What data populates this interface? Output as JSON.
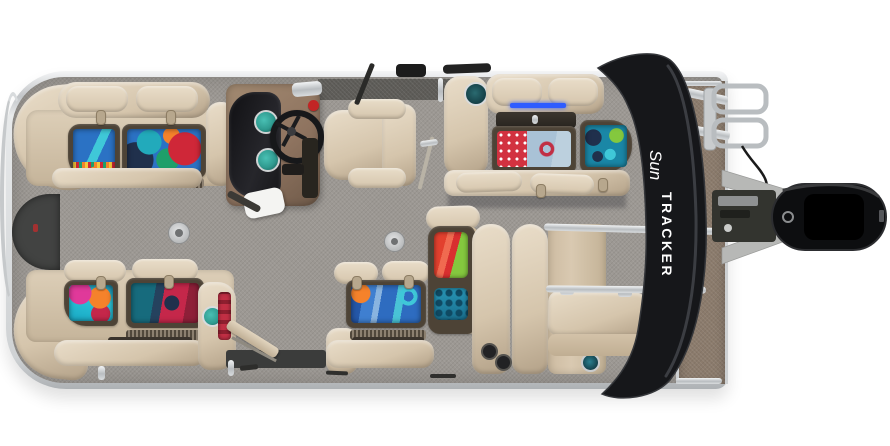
{
  "alt": "Overhead view of a SUN TRACKER pontoon boat: tan upholstered lounges with open storage bins of colorful gear, brown helm console with steering wheel, captain's chair, gray woven deck carpet, folded black bimini top with brand logo, taupe stern deck, boarding ladder, gray pontoon tubes and black outboard motor",
  "bimini": {
    "logo_script": "Sun",
    "logo_block": "TRACKER"
  },
  "colors": {
    "background": "#ffffff",
    "chrome_rail": "#d7d9db",
    "deck_carpet_gray": "#9c9893",
    "stern_deck_taupe": "#8b7b6c",
    "upholstery_tan": "#d5c5ac",
    "upholstery_highlight": "#e9ddc9",
    "upholstery_shadow": "#b3a188",
    "storage_bin_frame": "#4d4336",
    "helm_console_brown": "#8f7460",
    "dash_panel_black": "#1e1e21",
    "gauge_teal": "#2f9a8f",
    "bimini_black": "#16171a",
    "outboard_motor_black": "#0d0e10",
    "pontoon_gray": "#b7b8b6",
    "bow_gate_dark": "#424342",
    "led_accent_blue": "#2e5cff",
    "kill_switch_red": "#c22525"
  },
  "gear_colors": {
    "towel_blue": "#2b72c4",
    "light_blue": "#89b4e0",
    "aqua": "#3fc8d8",
    "teal": "#22aabb",
    "deep_teal": "#1a87a6",
    "navy": "#20304c",
    "red": "#cf2738",
    "crimson": "#c5274a",
    "orange": "#f5822b",
    "green": "#1f9f6a",
    "lime": "#84c83e",
    "pink": "#e0399a",
    "polka_red": "#d23240",
    "polka_dot_white": "#ffffff",
    "denim_blue": "#a9c2d6",
    "jacket_red": "#e2402e",
    "strap_red": "#c12f44",
    "yellow": "#f2c83a"
  }
}
